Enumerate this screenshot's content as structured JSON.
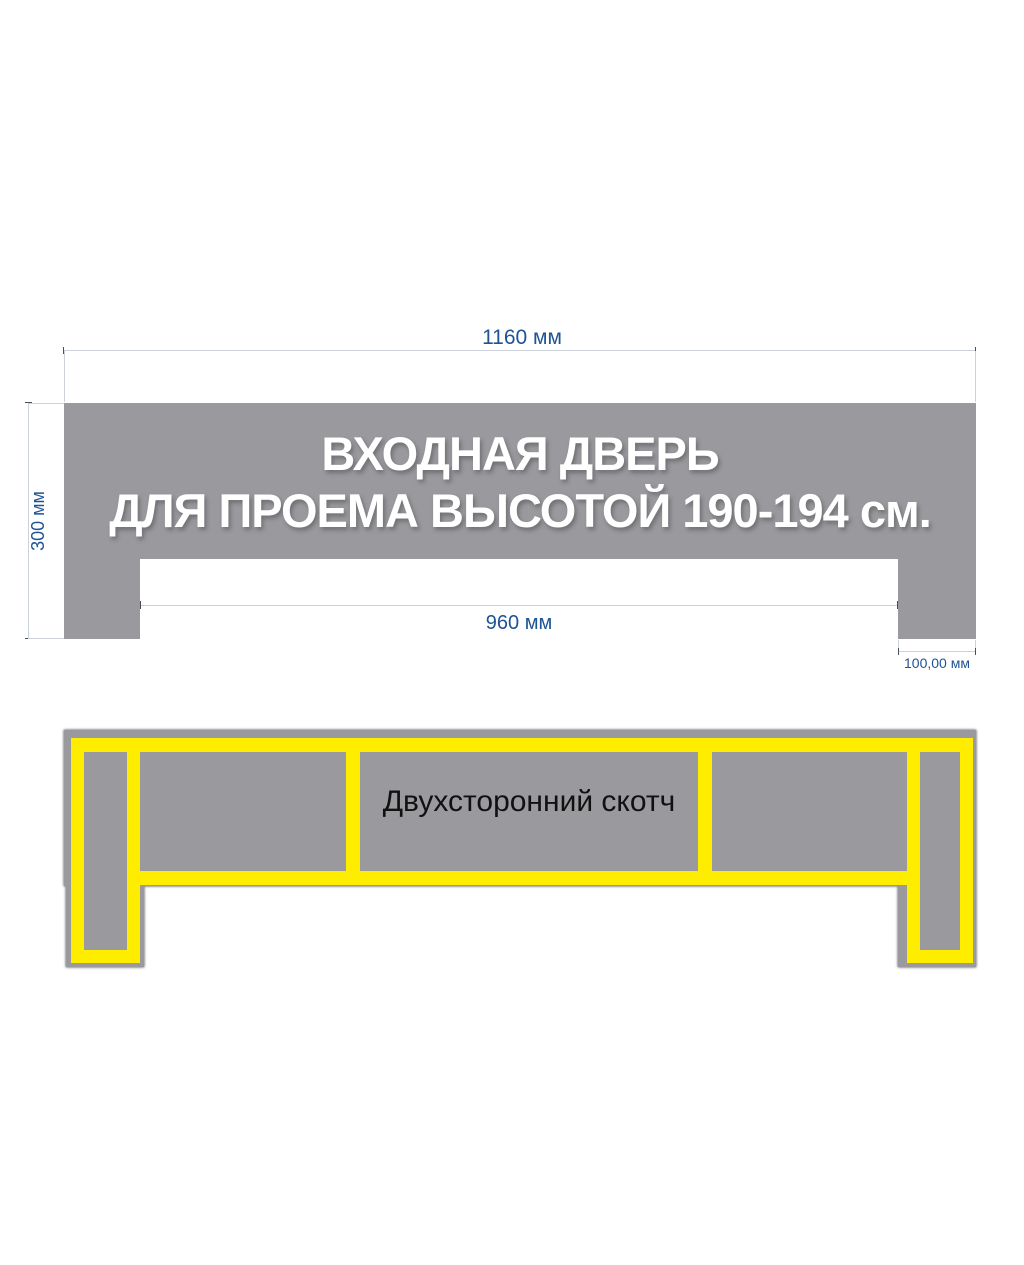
{
  "top_figure": {
    "title_line1": "ВХОДНАЯ ДВЕРЬ",
    "title_line2": "ДЛЯ ПРОЕМА ВЫСОТОЙ 190-194 см.",
    "dimensions": {
      "total_width": "1160 мм",
      "height": "300 мм",
      "opening_width": "960 мм",
      "leg_width": "100,00 мм"
    }
  },
  "bottom_figure": {
    "tape_label": "Двухсторонний скотч"
  },
  "colors": {
    "panel_gray": "#9A9A9E",
    "tape_yellow": "#FFED00",
    "dimension_text_blue": "#1E5394",
    "dimension_line_gray": "#CDD2DA",
    "title_text_white": "#FFFFFF",
    "tape_text_black": "#111111"
  }
}
